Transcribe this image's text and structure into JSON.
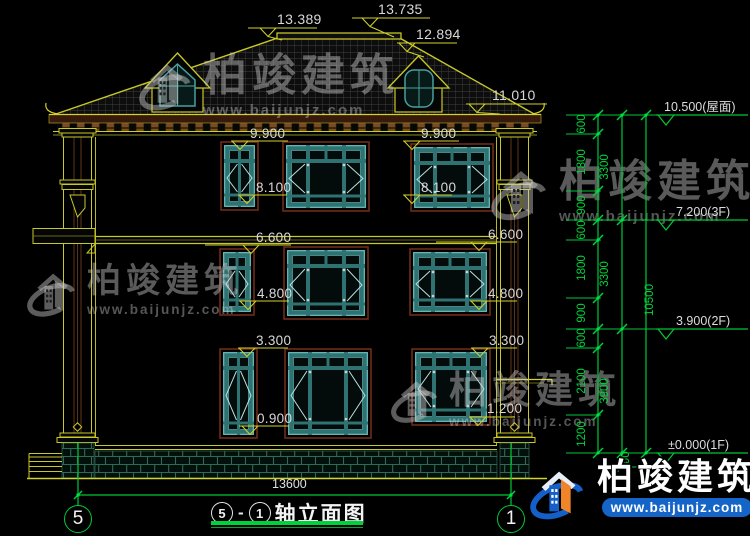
{
  "brand": {
    "name": "柏竣建筑",
    "site": "www.baijunjz.com"
  },
  "title": {
    "axis_left": "5",
    "dash": "-",
    "axis_right": "1",
    "name": "轴立面图"
  },
  "figure": {
    "roof_dims": [
      {
        "text": "13.389",
        "tx": 277,
        "ty": 12,
        "lx1": 248,
        "lx2": 317,
        "ly": 28,
        "ax": 268,
        "dx": 282,
        "dy": 40
      },
      {
        "text": "13.735",
        "tx": 378,
        "ty": 2,
        "lx1": 352,
        "lx2": 430,
        "ly": 18,
        "ax": 370,
        "dx": 394,
        "dy": 37
      },
      {
        "text": "12.894",
        "tx": 416,
        "ty": 27,
        "lx1": 397,
        "lx2": 457,
        "ly": 43,
        "ax": 407,
        "dx": 424,
        "dy": 57
      },
      {
        "text": "11.010",
        "tx": 492,
        "ty": 88,
        "lx1": 466,
        "lx2": 547,
        "ly": 104,
        "ax": 477,
        "dx": 500,
        "dy": 114
      }
    ],
    "elev_dims": [
      {
        "text": "9.900",
        "tx": 250,
        "ty": 126,
        "lx1": 231,
        "lx2": 288,
        "ly": 141,
        "ax": 240
      },
      {
        "text": "9.900",
        "tx": 421,
        "ty": 126,
        "lx1": 403,
        "lx2": 459,
        "ly": 141,
        "ax": 412
      },
      {
        "text": "8.100",
        "tx": 256,
        "ty": 180,
        "lx1": 238,
        "lx2": 287,
        "ly": 195,
        "ax": 247
      },
      {
        "text": "8.100",
        "tx": 421,
        "ty": 180,
        "lx1": 403,
        "lx2": 452,
        "ly": 195,
        "ax": 412
      },
      {
        "text": "6.600",
        "tx": 256,
        "ty": 230,
        "lx1": 205,
        "lx2": 291,
        "ly": 245,
        "ax": 251
      },
      {
        "text": "6.600",
        "tx": 488,
        "ty": 227,
        "lx1": 436,
        "lx2": 517,
        "ly": 242,
        "ax": 479
      },
      {
        "text": "4.800",
        "tx": 257,
        "ty": 286,
        "lx1": 239,
        "lx2": 289,
        "ly": 301,
        "ax": 248
      },
      {
        "text": "4.800",
        "tx": 488,
        "ty": 286,
        "lx1": 470,
        "lx2": 517,
        "ly": 301,
        "ax": 479
      },
      {
        "text": "3.300",
        "tx": 256,
        "ty": 333,
        "lx1": 238,
        "lx2": 288,
        "ly": 348,
        "ax": 247
      },
      {
        "text": "3.300",
        "tx": 489,
        "ty": 333,
        "lx1": 471,
        "lx2": 517,
        "ly": 348,
        "ax": 480
      },
      {
        "text": "0.900",
        "tx": 257,
        "ty": 411,
        "lx1": 239,
        "lx2": 289,
        "ly": 426,
        "ax": 250
      },
      {
        "text": "1.200",
        "tx": 487,
        "ty": 401,
        "lx1": 469,
        "lx2": 515,
        "ly": 417,
        "ax": 478
      }
    ],
    "levels": [
      {
        "text": "10.500(屋面)",
        "y": 115,
        "tx": 664
      },
      {
        "text": "7.200(3F)",
        "y": 220,
        "tx": 676
      },
      {
        "text": "3.900(2F)",
        "y": 329,
        "tx": 676
      },
      {
        "text": "±0.000(1F)",
        "y": 453,
        "tx": 668
      }
    ],
    "chains": [
      {
        "x": 598,
        "label_x": 585,
        "points": [
          115,
          134,
          191,
          220,
          240,
          298,
          329,
          348,
          415,
          453
        ],
        "labels": [
          {
            "v": "600",
            "y": 124
          },
          {
            "v": "1800",
            "y": 162
          },
          {
            "v": "900",
            "y": 205
          },
          {
            "v": "600",
            "y": 230
          },
          {
            "v": "1800",
            "y": 268
          },
          {
            "v": "900",
            "y": 313
          },
          {
            "v": "600",
            "y": 338
          },
          {
            "v": "2100",
            "y": 381
          },
          {
            "v": "1200",
            "y": 434
          }
        ]
      },
      {
        "x": 622,
        "label_x": 608,
        "points": [
          115,
          220,
          329,
          453,
          467
        ],
        "labels": [
          {
            "v": "3300",
            "y": 167
          },
          {
            "v": "3300",
            "y": 274
          },
          {
            "v": "3900",
            "y": 391
          },
          {
            "v": "450",
            "y": 461,
            "lx": 629
          }
        ]
      },
      {
        "x": 646,
        "label_x": 653,
        "points": [
          115,
          453
        ],
        "labels": [
          {
            "v": "10500",
            "y": 300
          }
        ]
      }
    ],
    "ext_short_y": [
      134,
      191,
      240,
      298,
      348,
      415
    ],
    "ext_long_y": [
      115,
      220,
      329,
      453
    ],
    "ext_ground": {
      "y": 467,
      "x1": 600,
      "x2": 650
    },
    "span": {
      "text": "13600",
      "y": 495,
      "x1": 78,
      "x2": 511,
      "tx": 272,
      "ty": 488
    },
    "grid": {
      "left": {
        "label": "5",
        "x": 78
      },
      "right": {
        "label": "1",
        "x": 511
      },
      "line_y1": 443,
      "line_y2": 506,
      "bubble_cy": 519
    },
    "windows": [
      {
        "x": 224,
        "y": 145,
        "w": 31,
        "h": 62,
        "type": "narrow"
      },
      {
        "x": 286,
        "y": 145,
        "w": 80,
        "h": 63,
        "type": "wide"
      },
      {
        "x": 414,
        "y": 147,
        "w": 76,
        "h": 61,
        "type": "wide"
      },
      {
        "x": 223,
        "y": 252,
        "w": 28,
        "h": 60,
        "type": "narrow"
      },
      {
        "x": 287,
        "y": 250,
        "w": 78,
        "h": 66,
        "type": "wide"
      },
      {
        "x": 413,
        "y": 252,
        "w": 74,
        "h": 60,
        "type": "wide"
      },
      {
        "x": 223,
        "y": 352,
        "w": 31,
        "h": 83,
        "type": "narrow"
      },
      {
        "x": 288,
        "y": 352,
        "w": 80,
        "h": 83,
        "type": "wide"
      },
      {
        "x": 415,
        "y": 352,
        "w": 72,
        "h": 70,
        "type": "wide"
      }
    ]
  }
}
